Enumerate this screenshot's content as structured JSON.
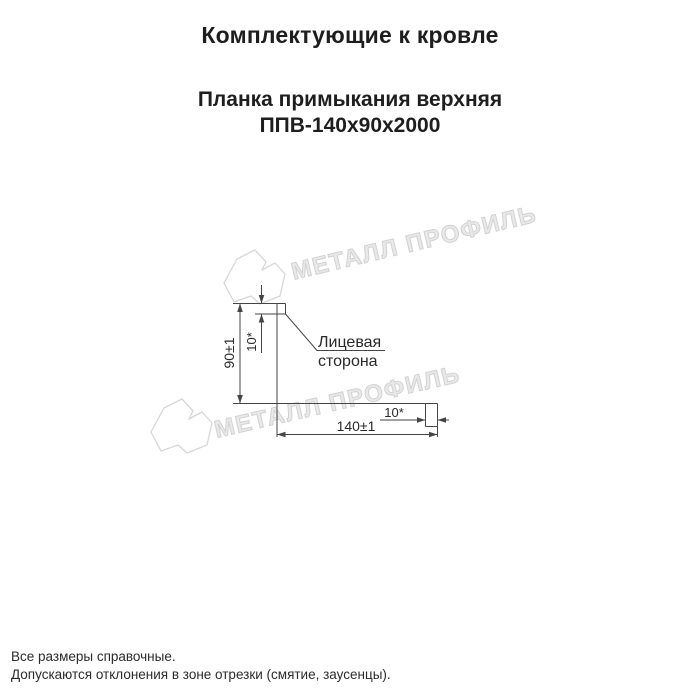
{
  "header": {
    "title": "Комплектующие к кровле",
    "product_name": "Планка примыкания верхняя",
    "product_code": "ППВ-140х90х2000"
  },
  "drawing": {
    "dim_height": "90±1",
    "dim_width": "140±1",
    "dim_hem_top": "10*",
    "dim_hem_end": "10*",
    "face_side_line1": "Лицевая",
    "face_side_line2": "сторона"
  },
  "watermark": {
    "text": "МЕТАЛЛ ПРОФИЛЬ",
    "color": "#d2d2d2"
  },
  "footer": {
    "note1": "Все размеры справочные.",
    "note2": "Допускаются отклонения в зоне отрезки (смятие, заусенцы)."
  },
  "colors": {
    "line": "#454545",
    "text": "#1e1e1e",
    "background": "#ffffff"
  }
}
